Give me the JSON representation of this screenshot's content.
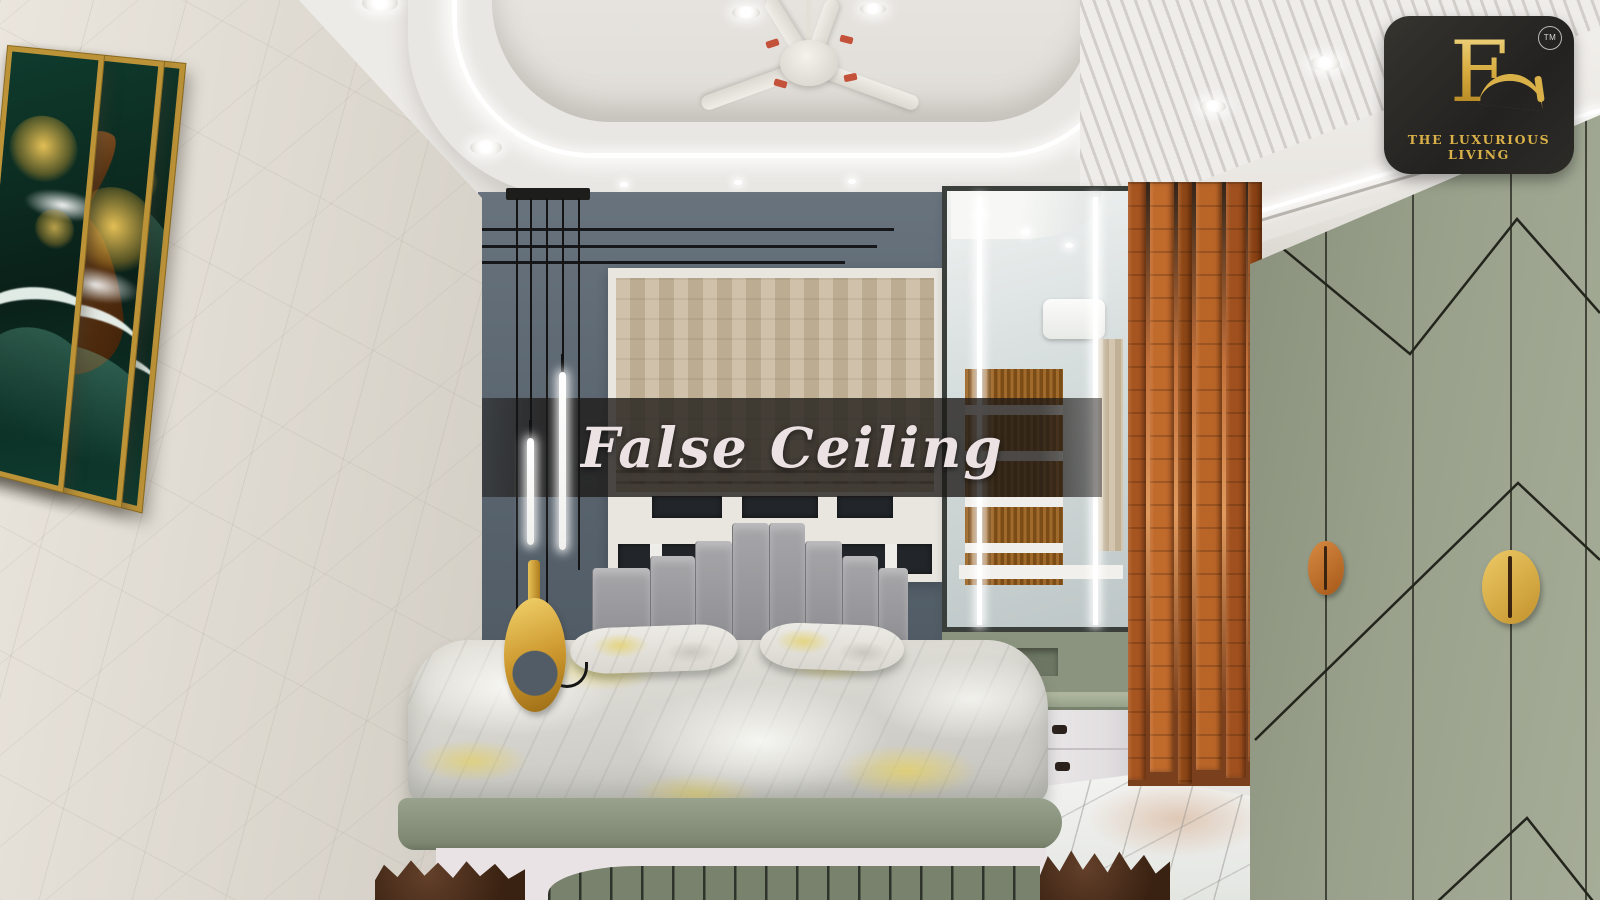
{
  "overlay": {
    "banner_text": "False Ceiling"
  },
  "brand": {
    "monogram": "F",
    "trademark": "TM",
    "name": "THE LUXURIOUS LIVING"
  },
  "palette": {
    "ceiling": "#e8e6e2",
    "led_light": "#ffffff",
    "left_wall": "#ddd8cf",
    "accent_wall": "#5a656f",
    "art_green": "#0f3b2d",
    "art_gold": "#d9b448",
    "headboard_gray": "#9a9a9e",
    "duvet_yellow": "#e4d06b",
    "bed_platform_sage": "#8b947b",
    "wardrobe_sage": "#99a18c",
    "wood_partition": "#c4713a",
    "handle_orange": "#c97a35",
    "handle_gold": "#e3bc55",
    "banner_bg": "rgba(28,25,23,0.75)",
    "banner_text_color": "#ece2e4",
    "logo_bg": "#2b2a28",
    "logo_gold": "#d9b148"
  }
}
